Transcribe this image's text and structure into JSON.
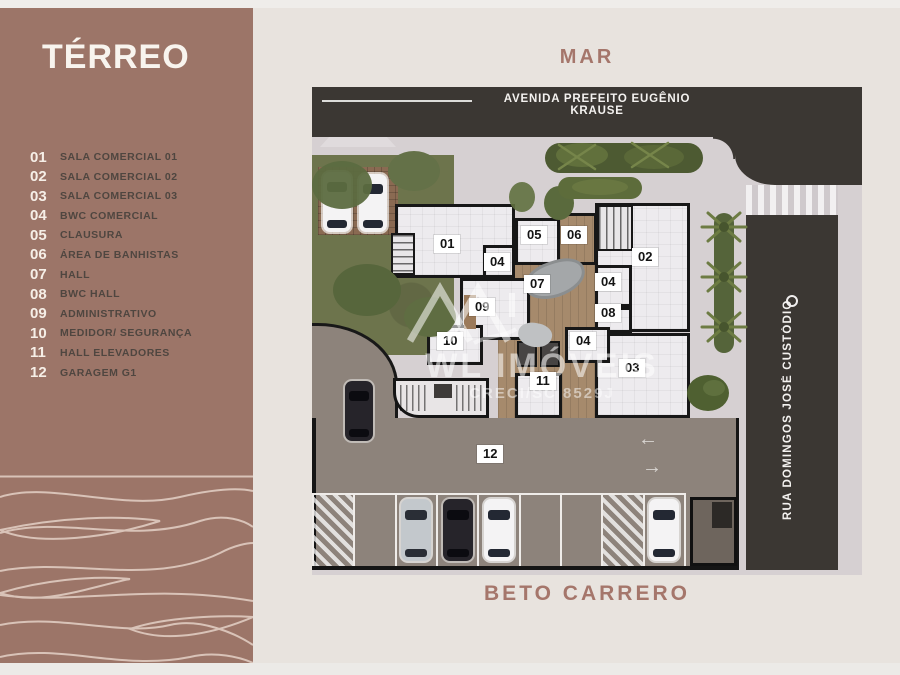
{
  "sidebar": {
    "title": "TÉRREO",
    "legend": [
      {
        "num": "01",
        "label": "SALA COMERCIAL 01"
      },
      {
        "num": "02",
        "label": "SALA COMERCIAL 02"
      },
      {
        "num": "03",
        "label": "SALA COMERCIAL 03"
      },
      {
        "num": "04",
        "label": "BWC COMERCIAL"
      },
      {
        "num": "05",
        "label": "CLAUSURA"
      },
      {
        "num": "06",
        "label": "ÁREA DE BANHISTAS"
      },
      {
        "num": "07",
        "label": "HALL"
      },
      {
        "num": "08",
        "label": "BWC HALL"
      },
      {
        "num": "09",
        "label": "ADMINISTRATIVO"
      },
      {
        "num": "10",
        "label": "MEDIDOR/ SEGURANÇA"
      },
      {
        "num": "11",
        "label": "HALL ELEVADORES"
      },
      {
        "num": "12",
        "label": "GARAGEM G1"
      }
    ]
  },
  "map": {
    "sea_label": "MAR",
    "avenue": "AVENIDA PREFEITO EUGÊNIO KRAUSE",
    "side_street": "RUA DOMINGOS JOSÉ CUSTÓDIO",
    "bottom_street": "BETO CARRERO",
    "markers": [
      "01",
      "04",
      "05",
      "06",
      "07",
      "09",
      "10",
      "11",
      "02",
      "04",
      "08",
      "04",
      "03",
      "12"
    ],
    "arrow_left": "←",
    "arrow_right": "→",
    "watermark": {
      "brand": "WL IMÓVEIS",
      "license": "CRECI/SC 8529J"
    }
  },
  "colors": {
    "sidebar": "#9c7568",
    "background": "#e8e3de",
    "road": "#3b3733",
    "ground": "#d6d0d2",
    "garage": "#8d837b",
    "grass": "#6d744c",
    "wood": "#a68a6c",
    "accent_text": "#a5766b",
    "legend_text": "#4f4640"
  }
}
